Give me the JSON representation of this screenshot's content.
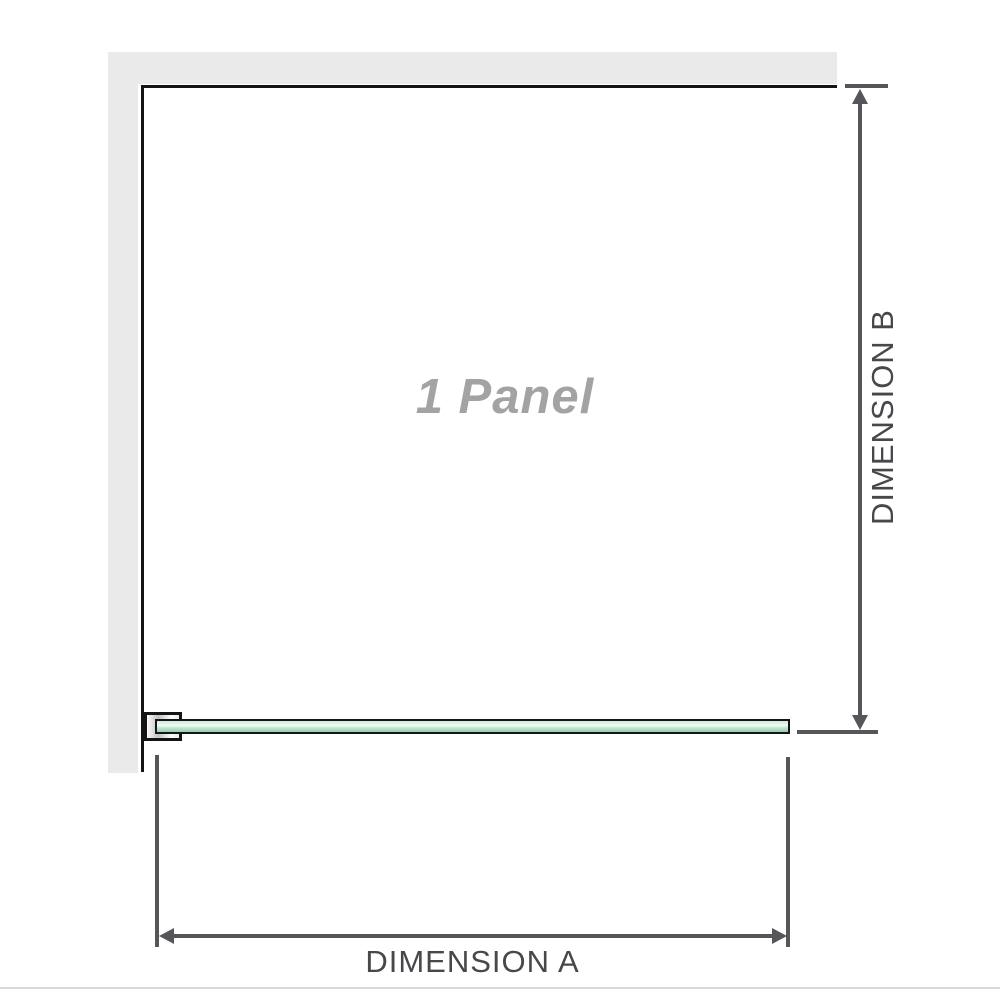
{
  "diagram": {
    "watermark_label": "1 Panel",
    "dimension_a_label": "DIMENSION A",
    "dimension_b_label": "DIMENSION B"
  },
  "colors": {
    "wall": "#eaeaea",
    "outline": "#141414",
    "dimension_line": "#55565a",
    "dimension_text": "#46484b",
    "watermark_text": "#a3a3a3",
    "glass_green_light": "#cfeadc",
    "glass_green_mid": "#f2fbf6",
    "glass_green_dark": "#96cfae",
    "glass_border": "#161616",
    "bracket_shade": "#c2c2c2",
    "page_divider": "#dcd8d4"
  }
}
